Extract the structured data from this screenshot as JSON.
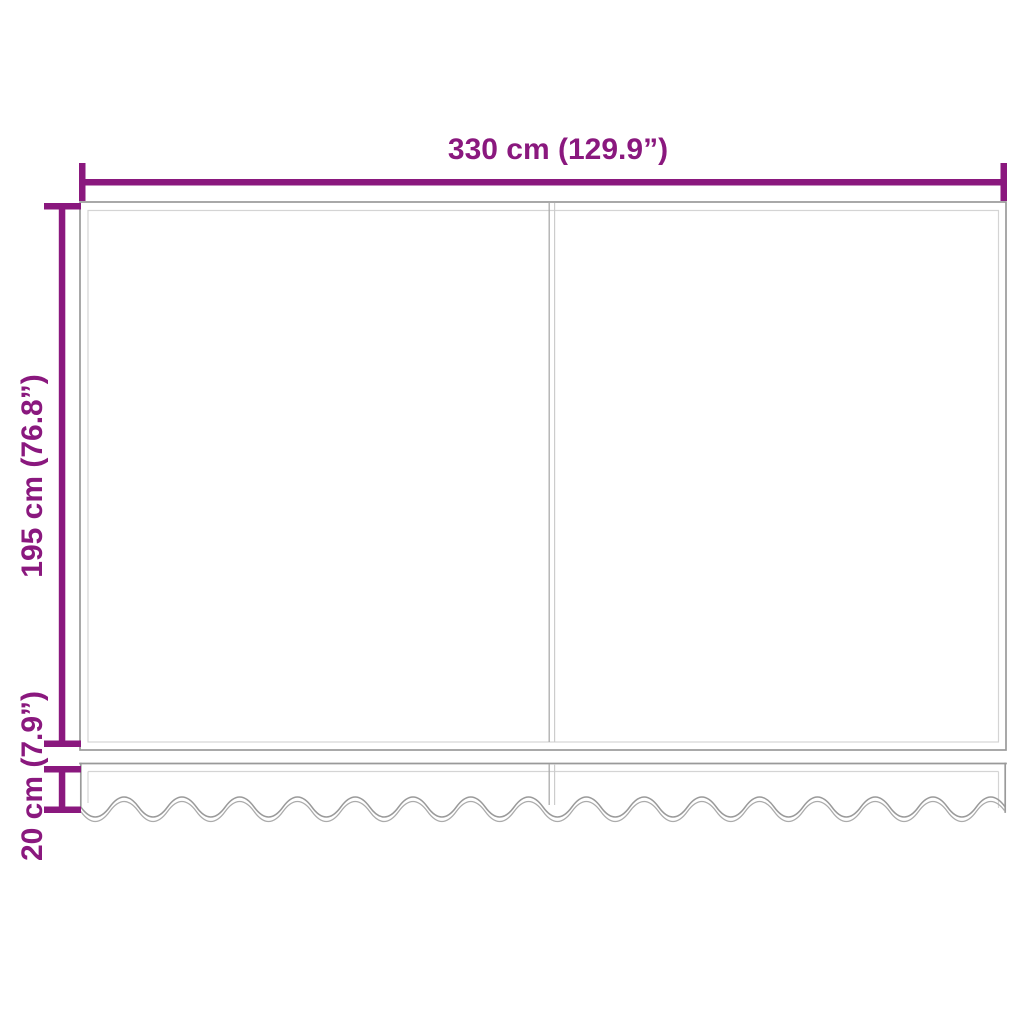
{
  "diagram": {
    "labels": {
      "width": "330 cm (129.9”)",
      "height": "195 cm (76.8”)",
      "valance_height": "20 cm (7.9”)"
    },
    "colors": {
      "dimension_accent": "#8a187e",
      "outline": "#9a9a9a",
      "outline_light": "#d4d4d4",
      "seam_dark": "#ababab",
      "seam_light": "#cccccc",
      "background": "#ffffff"
    }
  }
}
